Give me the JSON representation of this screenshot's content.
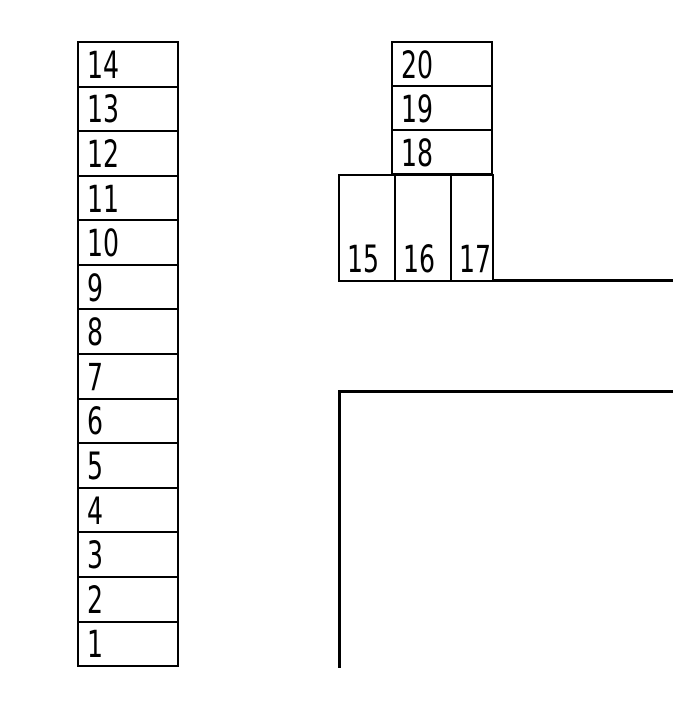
{
  "diagram": {
    "description": "Box stacking diagram with numbered blocks, a ground ledge and an L-shaped corner outline",
    "colors": {
      "line": "#000000",
      "background": "#ffffff",
      "text": "#000000"
    },
    "left_stack": {
      "labels": [
        "14",
        "13",
        "12",
        "11",
        "10",
        "9",
        "8",
        "7",
        "6",
        "5",
        "4",
        "3",
        "2",
        "1"
      ]
    },
    "right_top_stack": {
      "labels": [
        "20",
        "19",
        "18"
      ]
    },
    "right_bottom_row": {
      "labels": [
        "15",
        "16",
        "17"
      ]
    }
  }
}
